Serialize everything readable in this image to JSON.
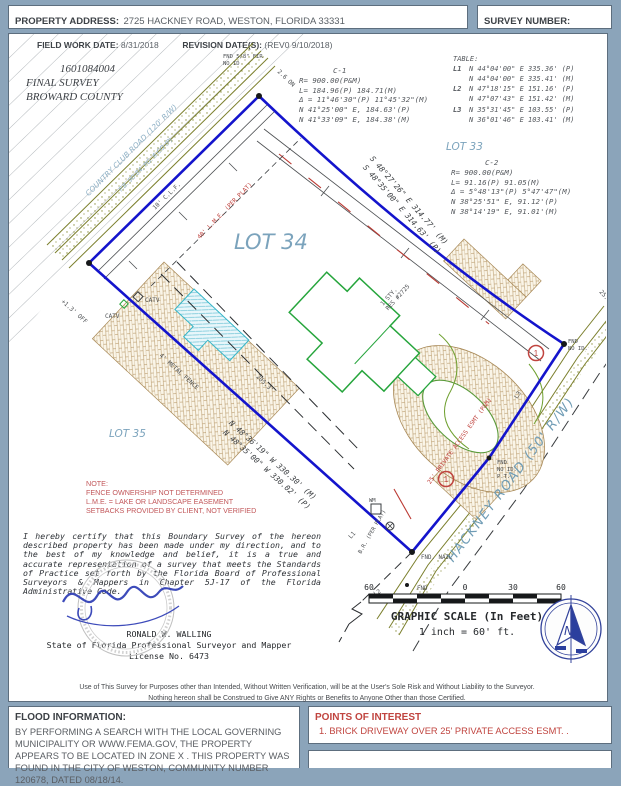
{
  "header": {
    "property_address_label": "PROPERTY ADDRESS:",
    "property_address_value": "2725 HACKNEY ROAD,  WESTON, FLORIDA 33331",
    "survey_number_label": "SURVEY NUMBER:",
    "survey_number_value": "1601.0840-04"
  },
  "main": {
    "field_work": {
      "date_label": "FIELD WORK DATE:",
      "date_value": "8/31/2018",
      "revision_label": "REVISION DATE(S):",
      "revision_value": "(REV0 9/10/2018)"
    },
    "job": {
      "number": "1601084004",
      "survey_type": "FINAL SURVEY",
      "county": "BROWARD COUNTY"
    },
    "curve_c1": {
      "title": "C-1",
      "lines": [
        "R= 900.00(P&M)",
        "L= 184.96(P) 184.71(M)",
        "Δ = 11°46'30\"(P) 11°45'32\"(M)",
        "N 41°25'00\" E, 184.63'(P)",
        "N 41°33'09\" E, 184.38'(M)"
      ]
    },
    "line_table": {
      "title": "TABLE:",
      "rows": [
        {
          "id": "L1",
          "p": "N 44°04'00\" E 335.36' (P)",
          "m": "N 44°04'00\" E 335.41' (M)"
        },
        {
          "id": "L2",
          "p": "N 47°18'15\" E 151.16' (P)",
          "m": "N 47°07'43\" E 151.42' (M)"
        },
        {
          "id": "L3",
          "p": "N 35°31'45\" E 103.55' (P)",
          "m": "N 36°01'46\" E 103.41' (M)"
        }
      ]
    },
    "curve_c2": {
      "title": "C-2",
      "lines": [
        "R= 900.00(P&M)",
        "L= 91.16(P) 91.05(M)",
        "Δ = 5°48'13\"(P) 5°47'47\"(M)",
        "N 38°25'51\" E, 91.12'(P)",
        "N 38°14'19\" E, 91.01'(M)"
      ]
    },
    "map": {
      "lots": {
        "lot33": "LOT 33",
        "lot34": "LOT 34",
        "lot35": "LOT 35"
      },
      "roads": {
        "hackney": "HACKNEY ROAD (50' R/W)",
        "country_club": "COUNTRY CLUB ROAD (120' R/W)",
        "country_club_plat": "P.B. 90-84, PG. 6 CO (P)"
      },
      "bearings": {
        "top_m": "S 48°27'26\" E 314.77' (M)",
        "top_p": "S 48°35'00\" E 314.63' (P)",
        "bottom_m": "N 48°36'19\" W 330.30' (M)",
        "bottom_p": "N 48°35'00\" W 330.02' (P)"
      },
      "labels": {
        "catv_a": "CATV",
        "catv_b": "CATV",
        "metal_fence": "4' METAL FENCE",
        "fence_off": "+1.3' OFF",
        "corner_on": "2.6 ON",
        "clf": "10' C.L.F.",
        "fir_1": "FND 5/8\" FIR",
        "fir_2": "NO ID",
        "dim_205": "205.3'",
        "res_1": "1 STY.",
        "res_2": "RES #2725",
        "fnd_nail": "FND. NAIL",
        "fnd": "FND",
        "fnd_noid_1": "FND",
        "fnd_noid_2": "NO ID.",
        "pt_1": "FND",
        "pt_2": "NO ID.",
        "pt_3": "P.T.",
        "l1": "L1",
        "l2": "L2",
        "l3": "L3",
        "br_plat": "B.R. (PER PLAT)",
        "access_esmt": "25' PRIVATE ACCESS ESMT (P&M)",
        "lme": "40' L.M.E. (PER PLAT)",
        "dim_25": "25.0'",
        "wm": "WM",
        "poi_marker": "1"
      }
    },
    "note": {
      "title": "NOTE:",
      "lines": [
        "FENCE OWNERSHIP NOT DETERMINED",
        "L.M.E. = LAKE OR LANDSCAPE EASEMENT",
        "SETBACKS PROVIDED BY CLIENT, NOT VERIFIED"
      ]
    },
    "certification": {
      "text": "I hereby certify that this Boundary Survey of the hereon described property has been made under my direction, and to the best of my knowledge and belief, it is a true and accurate representation of a survey that meets the Standards of Practice set forth by the Florida Board of Professional Surveyors & Mappers in Chapter 5J-17 of the Florida Administrative Code.",
      "surveyor_name": "RONALD W. WALLING",
      "surveyor_title": "State of Florida Professional Surveyor and Mapper",
      "license": "License  No. 6473"
    },
    "scale": {
      "ticks": [
        "60",
        "0",
        "30",
        "60"
      ],
      "title": "GRAPHIC SCALE (In Feet)",
      "ratio": "1 inch = 60' ft."
    },
    "compass": {
      "north": "N"
    },
    "disclaimer": {
      "line1": "Use of This Survey for Purposes other than Intended, Without Written Verification, will be at the User's Sole Risk and Without Liability to the Surveyor.",
      "line2": "Nothing hereon shall be Construed to Give ANY Rights or Benefits to Anyone Other than those Certified."
    }
  },
  "flood": {
    "title": "FLOOD INFORMATION:",
    "text": "BY PERFORMING A SEARCH WITH THE LOCAL GOVERNING MUNICIPALITY OR WWW.FEMA.GOV, THE PROPERTY APPEARS TO BE LOCATED IN ZONE X . THIS PROPERTY WAS FOUND IN THE CITY OF WESTON, COMMUNITY NUMBER 120678, DATED 08/18/14."
  },
  "poi": {
    "title": "POINTS OF INTEREST",
    "item1": "1. BRICK DRIVEWAY OVER 25' PRIVATE ACCESS ESMT. ."
  },
  "colors": {
    "frame": "#8ba4ba",
    "boundary_blue": "#1414cc",
    "label_blue": "#7ba3bc",
    "cad_gray": "#55595e",
    "red": "#c0443f",
    "olive": "#7b7f2c",
    "house_green": "#26a53c",
    "brick": "#b2915e",
    "compass_navy": "#33439b"
  }
}
